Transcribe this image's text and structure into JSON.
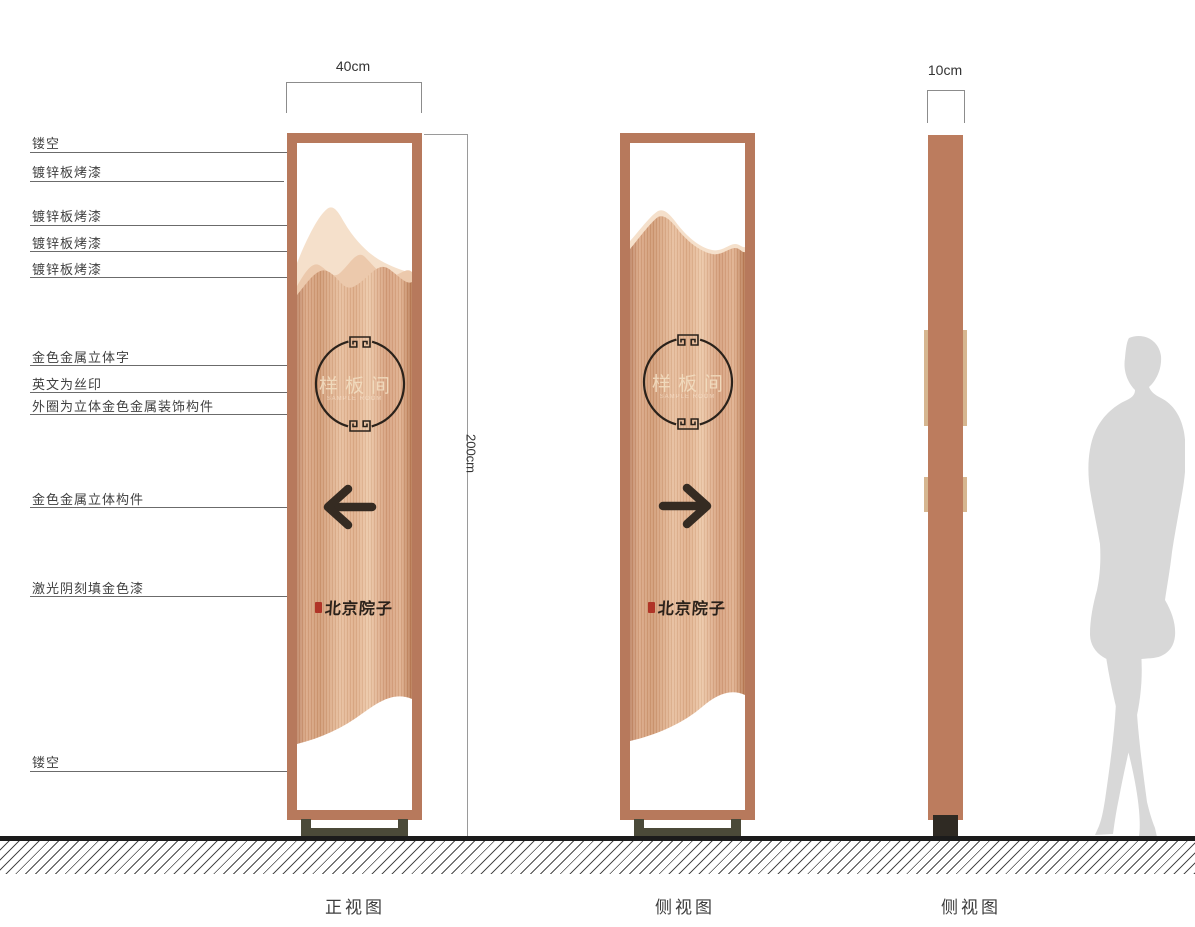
{
  "drawing": {
    "captions": {
      "front": "正视图",
      "side": "侧视图",
      "profile": "侧视图"
    },
    "dimensions": {
      "front_width": "40cm",
      "height": "200cm",
      "profile_width": "10cm"
    },
    "panel": {
      "circle_text": "样板间",
      "circle_subtext": "SAMPLE ROOM",
      "logo_text": "北京院子"
    },
    "annotations": [
      {
        "text": "镂空"
      },
      {
        "text": "镀锌板烤漆"
      },
      {
        "text": "镀锌板烤漆"
      },
      {
        "text": "镀锌板烤漆"
      },
      {
        "text": "镀锌板烤漆"
      },
      {
        "text": "金色金属立体字"
      },
      {
        "text": "英文为丝印"
      },
      {
        "text": "外圈为立体金色金属装饰构件"
      },
      {
        "text": "金色金属立体构件"
      },
      {
        "text": "激光阴刻填金色漆"
      },
      {
        "text": "镂空"
      }
    ],
    "colors": {
      "frame_copper": "#b7795c",
      "panel_highlight": "#f5e0cb",
      "panel_mid": "#ecc9ac",
      "detail_dark": "#352b22",
      "seal_red": "#b03427",
      "base_olive": "#4b4a39",
      "silhouette_gray": "#d8d8d8"
    }
  }
}
